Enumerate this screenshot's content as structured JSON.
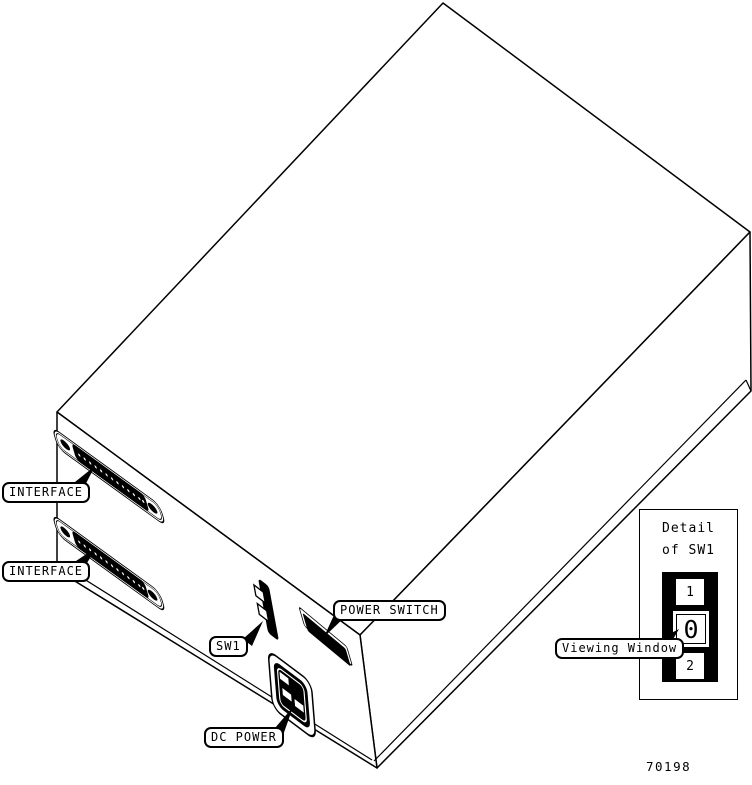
{
  "figure_number": "70198",
  "colors": {
    "ink": "#000000",
    "paper": "#ffffff"
  },
  "callouts": {
    "interface_top": {
      "label": "INTERFACE"
    },
    "interface_bottom": {
      "label": "INTERFACE"
    },
    "sw1": {
      "label": "SW1"
    },
    "power_switch": {
      "label": "POWER SWITCH"
    },
    "dc_power": {
      "label": "DC POWER"
    },
    "viewing_window": {
      "label": "Viewing Window"
    }
  },
  "detail_inset": {
    "title_line1": "Detail",
    "title_line2": "of SW1",
    "switch_positions": [
      "1",
      "0",
      "2"
    ],
    "selected_position": "0"
  }
}
